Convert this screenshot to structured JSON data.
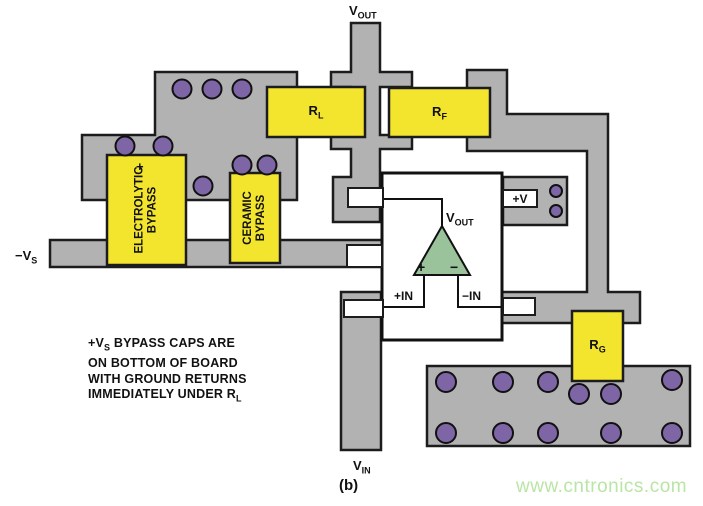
{
  "nets": {
    "vout_top": {
      "main": "V",
      "sub": "OUT"
    },
    "minus_vs": {
      "main": "−V",
      "sub": "S"
    },
    "vin": {
      "main": "V",
      "sub": "IN"
    },
    "plus_v": "+V"
  },
  "components": {
    "rl": {
      "main": "R",
      "sub": "L"
    },
    "rf": {
      "main": "R",
      "sub": "F"
    },
    "rg": {
      "main": "R",
      "sub": "G"
    },
    "electrolytic": {
      "line1": "ELECTROLYTIC",
      "line2": "BYPASS",
      "polarity": "+"
    },
    "ceramic": {
      "line1": "CERAMIC",
      "line2": "BYPASS"
    }
  },
  "opamp": {
    "vout": {
      "main": "V",
      "sub": "OUT"
    },
    "plus_in": "+IN",
    "minus_in": "−IN",
    "plus_sign": "+",
    "minus_sign": "−"
  },
  "note": {
    "line1_pre": "+V",
    "line1_sub": "S",
    "line1_post": " BYPASS CAPS ARE",
    "line2": "ON BOTTOM OF BOARD",
    "line3": "WITH GROUND RETURNS",
    "line4_pre": "IMMEDIATELY UNDER R",
    "line4_sub": "L"
  },
  "caption": "(b)",
  "watermark": "www.cntronics.com",
  "colors": {
    "trace": "#b2b2b2",
    "component": "#f3e42e",
    "via": "#7e66a6",
    "opamp_triangle": "#9bc39b",
    "watermark": "#b9e5a5"
  }
}
